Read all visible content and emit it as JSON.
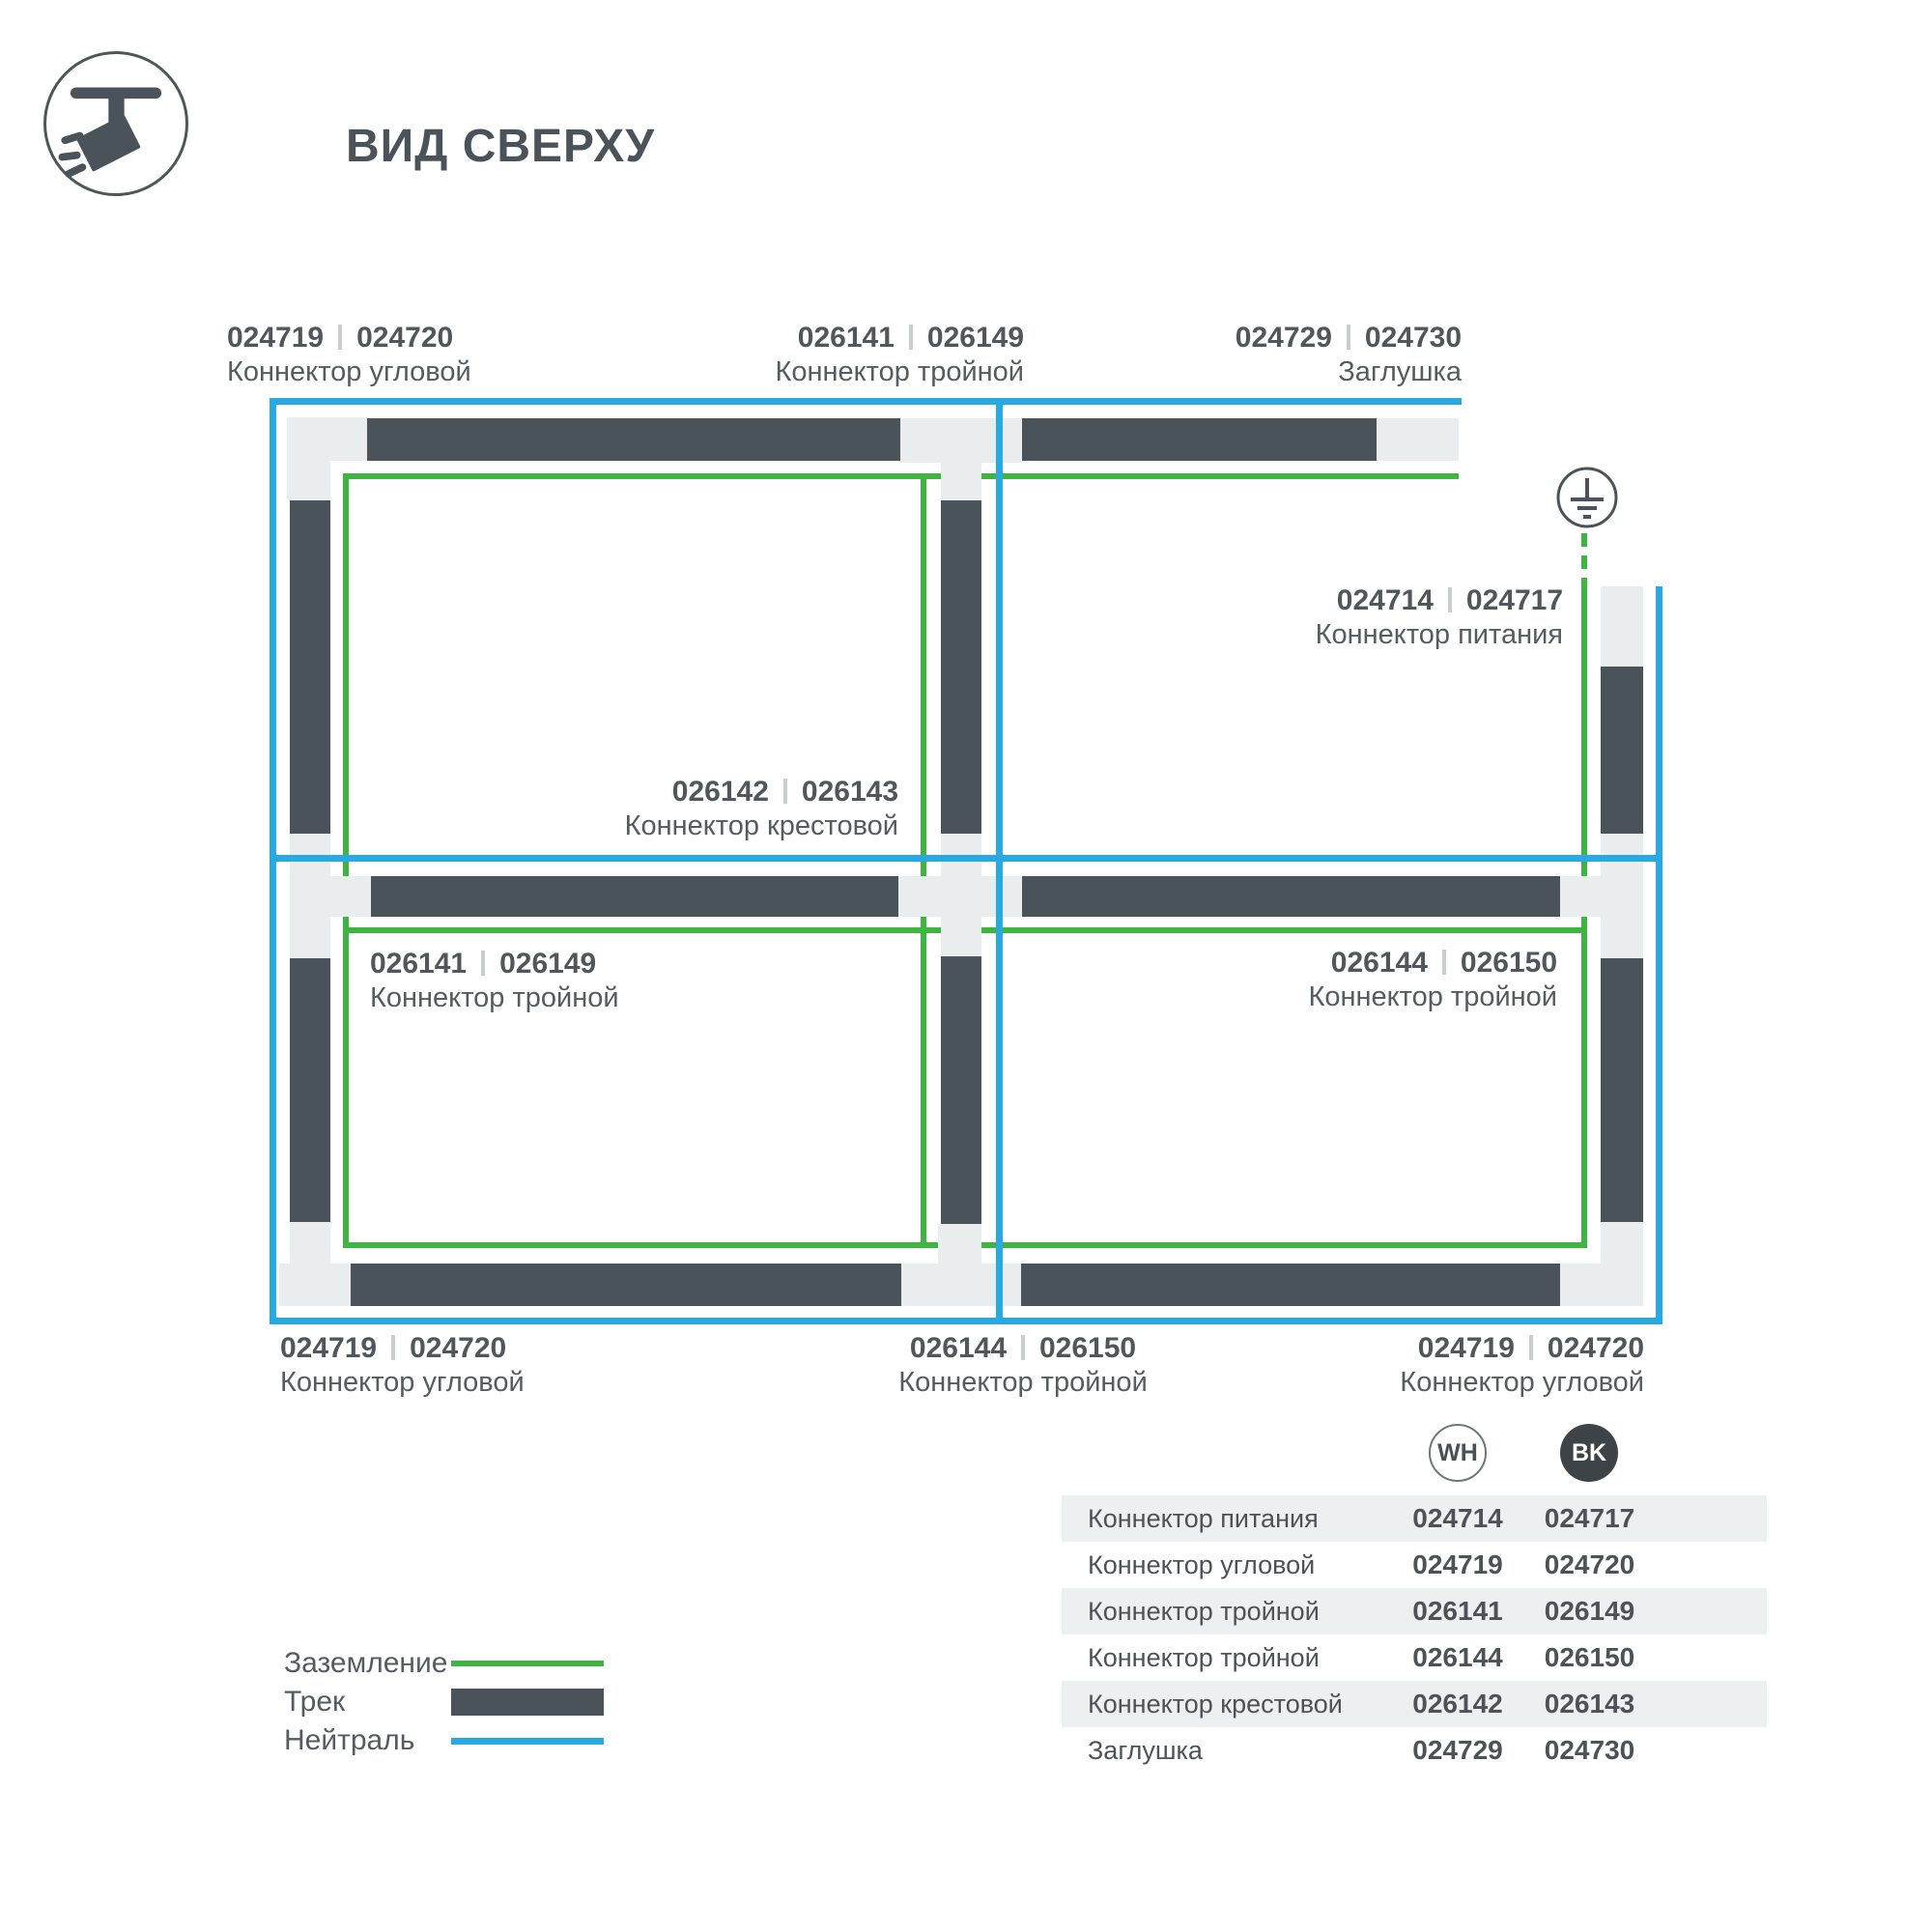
{
  "header": {
    "title": "ВИД СВЕРХУ",
    "icon": "track-spotlight"
  },
  "diagram": {
    "ground_symbol": "earth-ground",
    "labels": [
      {
        "id": "top-left-corner",
        "wh": "024719",
        "bk": "024720",
        "name": "Коннектор угловой"
      },
      {
        "id": "top-middle-triple",
        "wh": "026141",
        "bk": "026149",
        "name": "Коннектор тройной"
      },
      {
        "id": "top-right-endcap",
        "wh": "024729",
        "bk": "024730",
        "name": "Заглушка"
      },
      {
        "id": "power-connector",
        "wh": "024714",
        "bk": "024717",
        "name": "Коннектор питания"
      },
      {
        "id": "cross-connector",
        "wh": "026142",
        "bk": "026143",
        "name": "Коннектор крестовой"
      },
      {
        "id": "left-triple",
        "wh": "026141",
        "bk": "026149",
        "name": "Коннектор тройной"
      },
      {
        "id": "right-triple",
        "wh": "026144",
        "bk": "026150",
        "name": "Коннектор тройной"
      },
      {
        "id": "bottom-left-corner",
        "wh": "024719",
        "bk": "024720",
        "name": "Коннектор угловой"
      },
      {
        "id": "bottom-middle-triple",
        "wh": "026144",
        "bk": "026150",
        "name": "Коннектор тройной"
      },
      {
        "id": "bottom-right-corner",
        "wh": "024719",
        "bk": "024720",
        "name": "Коннектор угловой"
      }
    ]
  },
  "legend": {
    "items": [
      {
        "label": "Заземление",
        "swatch": "ground-line"
      },
      {
        "label": "Трек",
        "swatch": "track-bar"
      },
      {
        "label": "Нейтраль",
        "swatch": "neutral-line"
      }
    ]
  },
  "table": {
    "columns": [
      {
        "label": "WH"
      },
      {
        "label": "BK"
      }
    ],
    "rows": [
      {
        "name": "Коннектор питания",
        "wh": "024714",
        "bk": "024717"
      },
      {
        "name": "Коннектор угловой",
        "wh": "024719",
        "bk": "024720"
      },
      {
        "name": "Коннектор тройной",
        "wh": "026141",
        "bk": "026149"
      },
      {
        "name": "Коннектор тройной",
        "wh": "026144",
        "bk": "026150"
      },
      {
        "name": "Коннектор крестовой",
        "wh": "026142",
        "bk": "026143"
      },
      {
        "name": "Заглушка",
        "wh": "024729",
        "bk": "024730"
      }
    ]
  },
  "colors": {
    "ground": "#3db540",
    "neutral": "#29a9e2",
    "track": "#4a525a",
    "connector_piece": "#e9edee",
    "table_stripe": "#edf0f0",
    "bk_chip": "#3d4347"
  }
}
